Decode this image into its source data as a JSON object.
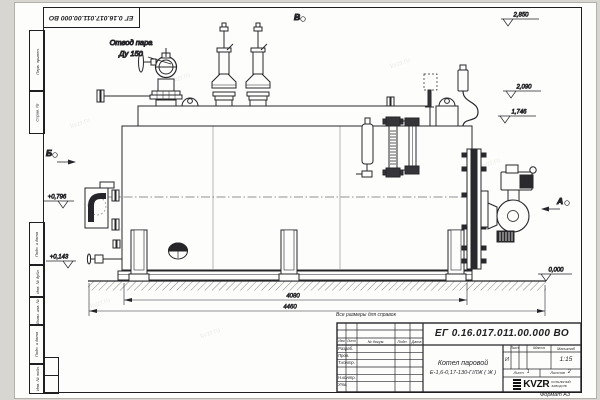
{
  "doc": {
    "number": "ЕГ 0.16.017.011.00.000  ВО",
    "format": "Формат А3",
    "reference_note": "Все размеры для справок"
  },
  "frame": {
    "left_labels": [
      "Перв. примен.",
      "Справ. №",
      "Подп. и дата",
      "Инв. № дубл.",
      "Взам. инв. №",
      "Подп. и дата",
      "Инв. № подл."
    ]
  },
  "drawing": {
    "callout_steam_line1": "Отвод пара",
    "callout_steam_line2": "Ду 150",
    "view_top": "В",
    "view_left": "Б",
    "view_right": "А",
    "elev_2850": "2,850",
    "elev_2090": "2,090",
    "elev_1746": "1,746",
    "elev_0796": "+0,796",
    "elev_0143": "+0,143",
    "elev_0000": "0,000",
    "dim_inner": "4080",
    "dim_overall": "4460"
  },
  "titleblock": {
    "doc_number": "ЕГ 0.16.017.011.00.000  ВО",
    "col_izm": "Изм",
    "col_list": "Лист",
    "col_doc": "№ докум.",
    "col_podp": "Подп.",
    "col_data": "Дата",
    "row_razrab": "Разраб.",
    "row_prov": "Пров.",
    "row_tkontr": "Т.контр.",
    "row_nkontr": "Н.контр.",
    "row_utv": "Утв.",
    "product_line1": "Котел паровой",
    "product_line2": "Е-1,6-0,17-130-Г/ЛЖ ( Ж )",
    "lit_label": "Лит.",
    "lit_value": "И",
    "mass_label": "Масса",
    "scale_label": "Масштаб",
    "scale_value": "1:15",
    "sheet_label": "Лист",
    "sheet_value": "1",
    "sheets_label": "Листов",
    "sheets_value": "2",
    "logo_text": "KVZR",
    "logo_sub1": "КОТЕЛЬНЫЙ",
    "logo_sub2": "ЗАВОД РФ"
  },
  "watermark": "kvzr.ru"
}
